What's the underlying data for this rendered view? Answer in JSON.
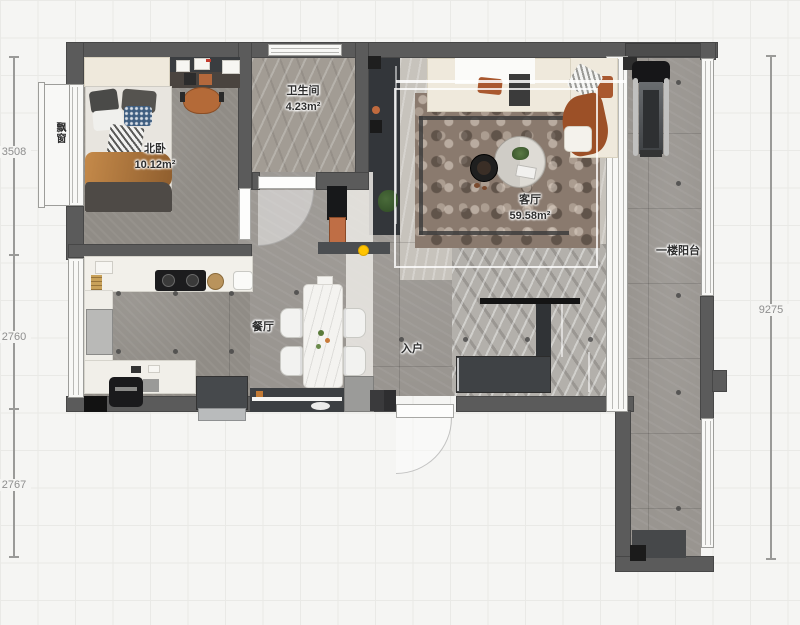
{
  "rooms": {
    "bedroom": {
      "name": "北卧",
      "area": "10.12m²"
    },
    "bathroom": {
      "name": "卫生间",
      "area": "4.23m²"
    },
    "living": {
      "name": "客厅",
      "area": "59.58m²"
    },
    "dining": {
      "name": "餐厅"
    },
    "entry": {
      "name": "入户"
    },
    "balcony": {
      "name": "一楼阳台"
    },
    "bay_window": {
      "name": "飘窗"
    }
  },
  "dimensions": {
    "left": [
      {
        "value": "3508"
      },
      {
        "value": "2760"
      },
      {
        "value": "2767"
      }
    ],
    "right": [
      {
        "value": "9275"
      }
    ]
  },
  "colors": {
    "wall": "#5b5b5b",
    "accent_rust": "#a9582f",
    "accent_orange": "#bf6e45",
    "marker_yellow": "#ffc400",
    "sofa_cream": "#efe9dc",
    "canvas_bg": "#f5f5f3"
  }
}
